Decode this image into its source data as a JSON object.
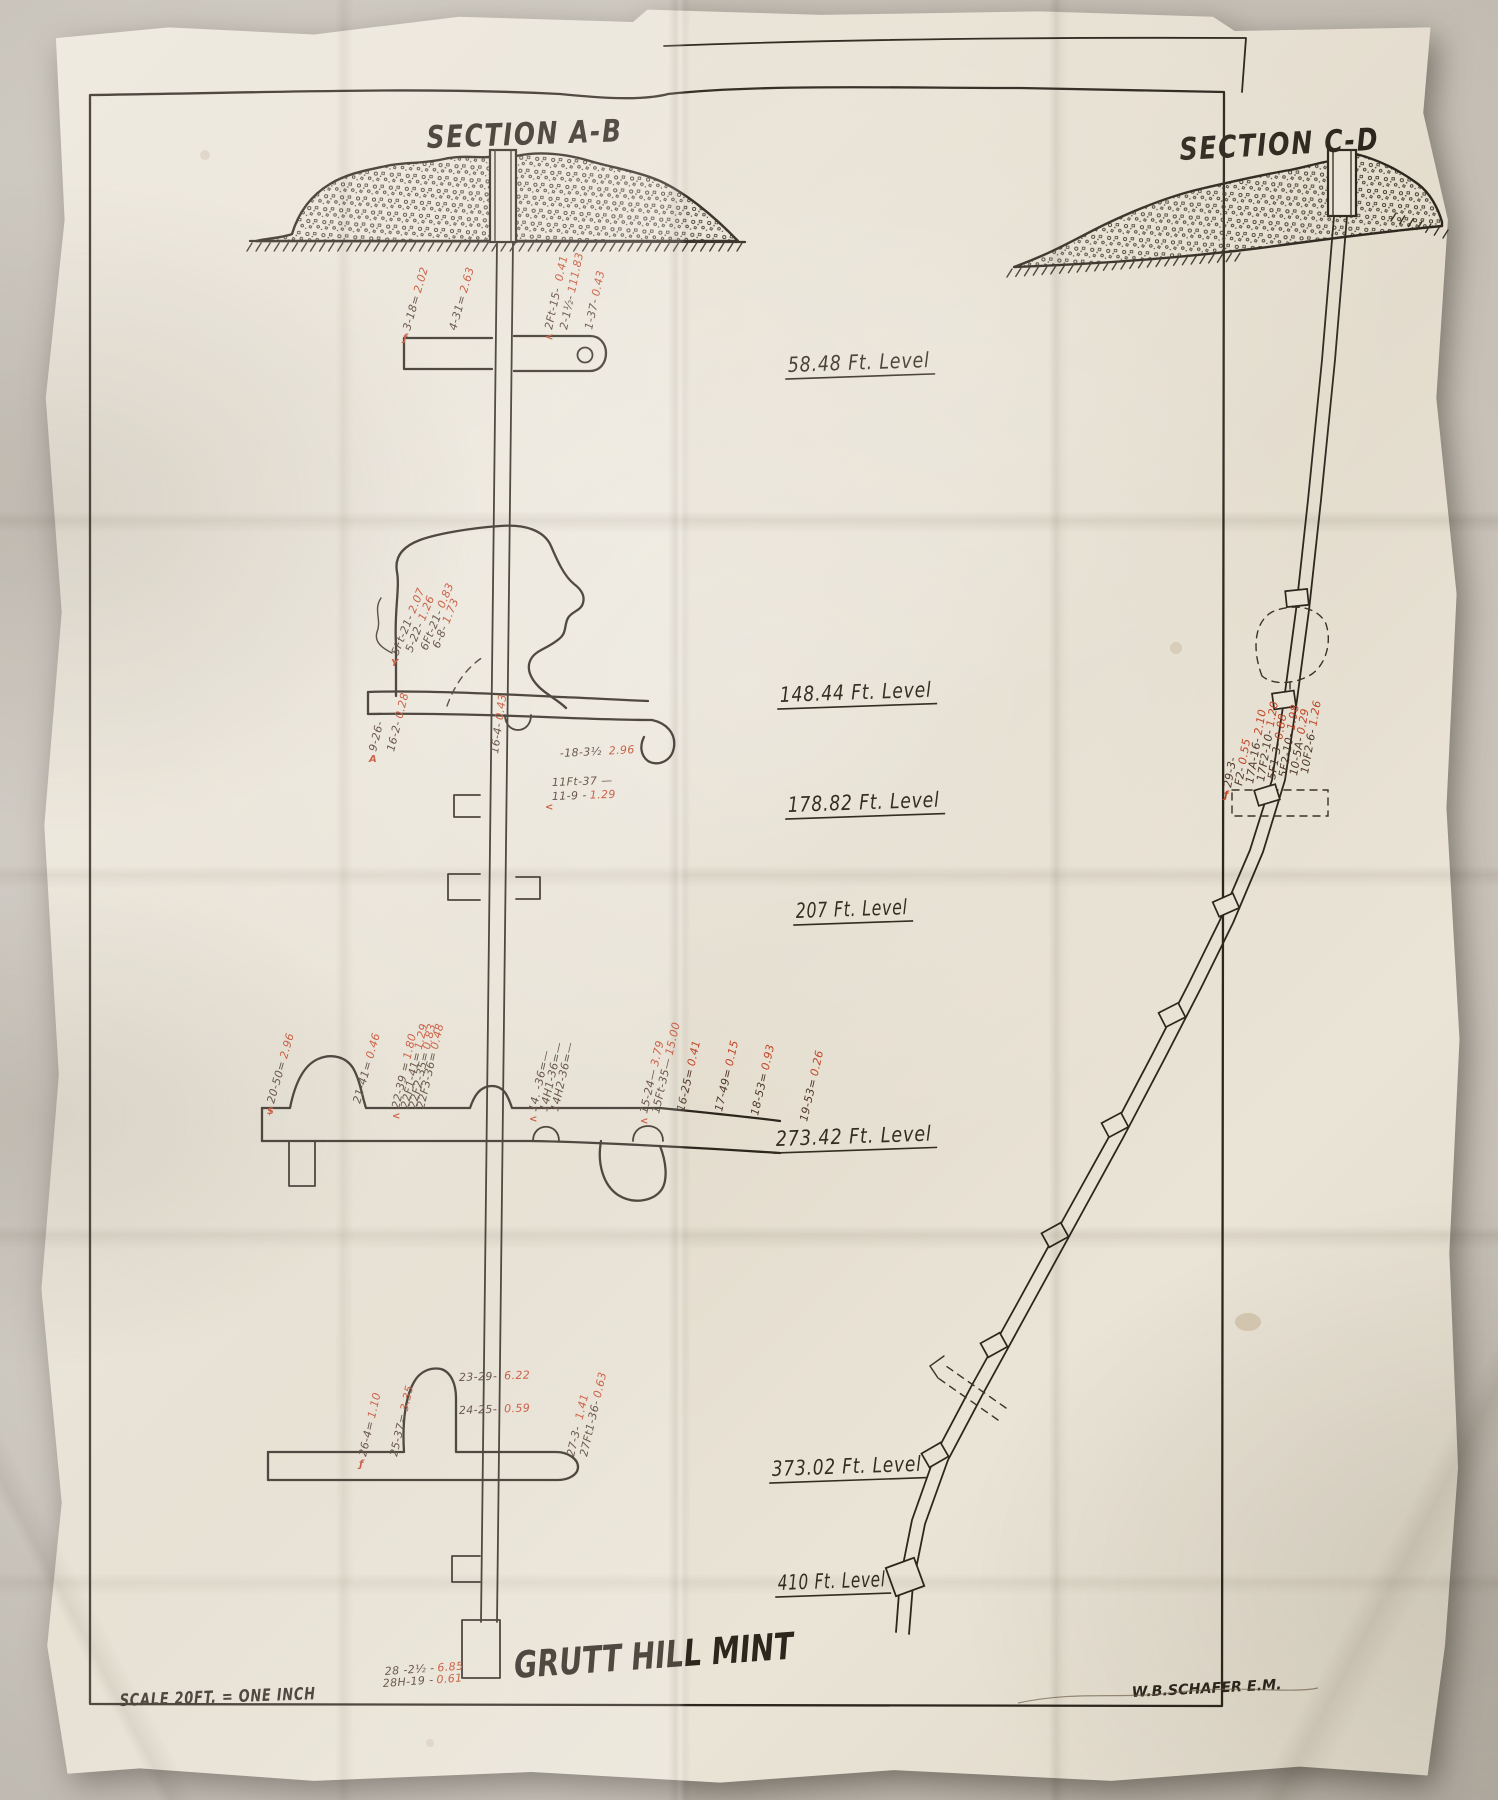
{
  "colors": {
    "ink": "#2d261d",
    "red_assay": "#c24526",
    "paper": "#e9e3d6"
  },
  "titles": {
    "section_ab": "SECTION A-B",
    "section_cd": "SECTION C-D"
  },
  "footer": {
    "mine_name": "GRUTT HILL MINT",
    "scale_note": "SCALE 20FT. = ONE INCH",
    "engineer": "W.B.SCHAFER E.M."
  },
  "levels": [
    {
      "label": "58.48 Ft. Level",
      "x": 788,
      "y": 372,
      "w": 142
    },
    {
      "label": "148.44 Ft. Level",
      "x": 780,
      "y": 702,
      "w": 152
    },
    {
      "label": "178.82 Ft. Level",
      "x": 788,
      "y": 812,
      "w": 152
    },
    {
      "label": "207 Ft. Level",
      "x": 796,
      "y": 918,
      "w": 112
    },
    {
      "label": "273.42 Ft. Level",
      "x": 776,
      "y": 1146,
      "w": 156
    },
    {
      "label": "373.02 Ft. Level",
      "x": 772,
      "y": 1476,
      "w": 150
    },
    {
      "label": "410 Ft. Level",
      "x": 778,
      "y": 1590,
      "w": 108
    }
  ],
  "annotations": [
    {
      "x": 410,
      "y": 331,
      "rot": -74,
      "black": "3-18=",
      "red": "2.02",
      "mark": "ƒ"
    },
    {
      "x": 456,
      "y": 331,
      "rot": -74,
      "black": "4-31=",
      "red": "2.63"
    },
    {
      "x": 552,
      "y": 330,
      "rot": -78,
      "black": "2Ft-15- ",
      "red": "0.41",
      "mark": "<"
    },
    {
      "x": 567,
      "y": 330,
      "rot": -78,
      "black": "2-1½-",
      "red": "111.83"
    },
    {
      "x": 592,
      "y": 330,
      "rot": -78,
      "black": "1-37-",
      "red": "0.43"
    },
    {
      "x": 398,
      "y": 656,
      "rot": -68,
      "black": "5Ft-21-",
      "red": "2.07",
      "mark": "Y"
    },
    {
      "x": 412,
      "y": 653,
      "rot": -68,
      "black": "5-22-",
      "red": "1.26"
    },
    {
      "x": 427,
      "y": 651,
      "rot": -68,
      "black": "6Ft-21-",
      "red": "0.83"
    },
    {
      "x": 439,
      "y": 649,
      "rot": -68,
      "black": "6-8-",
      "red": "1.73"
    },
    {
      "x": 376,
      "y": 752,
      "rot": -76,
      "black": "9-26-",
      "red": "",
      "mark": "A"
    },
    {
      "x": 394,
      "y": 752,
      "rot": -76,
      "black": "16-2-",
      "red": "0.28"
    },
    {
      "x": 498,
      "y": 754,
      "rot": -82,
      "black": "16-4-",
      "red": "0.43"
    },
    {
      "x": 560,
      "y": 757,
      "rot": -3,
      "black": "-18-3½ ",
      "red": "2.96"
    },
    {
      "x": 552,
      "y": 786,
      "rot": -2,
      "black": "11Ft-37 —",
      "red": ""
    },
    {
      "x": 552,
      "y": 800,
      "rot": -2,
      "black": "11-9 -",
      "red": "1.29",
      "mark": "<"
    },
    {
      "x": 274,
      "y": 1104,
      "rot": -74,
      "black": "20-50=",
      "red": "2.96",
      "mark": "$"
    },
    {
      "x": 360,
      "y": 1104,
      "rot": -74,
      "black": "21-41=",
      "red": "0.46"
    },
    {
      "x": 399,
      "y": 1109,
      "rot": -77,
      "black": "22-39 =",
      "red": "1.80",
      "mark": "<"
    },
    {
      "x": 408,
      "y": 1109,
      "rot": -77,
      "black": "22F1-41=",
      "red": "1.29"
    },
    {
      "x": 416,
      "y": 1109,
      "rot": -77,
      "black": "22F2-35=",
      "red": "0.83"
    },
    {
      "x": 424,
      "y": 1109,
      "rot": -77,
      "black": "22F3-36=",
      "red": "0.48"
    },
    {
      "x": 536,
      "y": 1112,
      "rot": -77,
      "black": "14. -36=—",
      "red": "",
      "mark": "<"
    },
    {
      "x": 547,
      "y": 1112,
      "rot": -77,
      "black": "14H1-36=—",
      "red": ""
    },
    {
      "x": 558,
      "y": 1112,
      "rot": -77,
      "black": "14H2-36=—",
      "red": ""
    },
    {
      "x": 647,
      "y": 1114,
      "rot": -77,
      "black": "15-24—",
      "red": "3.79",
      "mark": "<"
    },
    {
      "x": 659,
      "y": 1114,
      "rot": -77,
      "black": "15Ft-35—",
      "red": "15.00"
    },
    {
      "x": 684,
      "y": 1112,
      "rot": -77,
      "black": "16-25=",
      "red": "0.41"
    },
    {
      "x": 722,
      "y": 1112,
      "rot": -77,
      "black": "17-49=",
      "red": "0.15"
    },
    {
      "x": 758,
      "y": 1116,
      "rot": -77,
      "black": "18-53=",
      "red": "0.93"
    },
    {
      "x": 807,
      "y": 1122,
      "rot": -77,
      "black": "19-53=",
      "red": "0.26"
    },
    {
      "x": 366,
      "y": 1457,
      "rot": -77,
      "black": "26-4=",
      "red": "1.10",
      "mark": "ƒ"
    },
    {
      "x": 397,
      "y": 1457,
      "rot": -77,
      "black": "25-37=",
      "red": "3.35"
    },
    {
      "x": 459,
      "y": 1381,
      "rot": -2,
      "black": "23-29- ",
      "red": "6.22"
    },
    {
      "x": 459,
      "y": 1414,
      "rot": -2,
      "black": "24-25- ",
      "red": "0.59"
    },
    {
      "x": 574,
      "y": 1457,
      "rot": -77,
      "black": "27-3- ",
      "red": "1.41"
    },
    {
      "x": 587,
      "y": 1457,
      "rot": -77,
      "black": "27Ft1-36-",
      "red": "0.63"
    },
    {
      "x": 385,
      "y": 1675,
      "rot": -4,
      "black": "28 -2½ -",
      "red": "6.85"
    },
    {
      "x": 383,
      "y": 1687,
      "rot": -4,
      "black": "28H-19 -",
      "red": "0.61"
    },
    {
      "x": 1231,
      "y": 788,
      "rot": -80,
      "black": "29-3-",
      "red": "",
      "mark": "ƒ"
    },
    {
      "x": 1242,
      "y": 786,
      "rot": -80,
      "black": "F2-",
      "red": "0.55"
    },
    {
      "x": 1253,
      "y": 784,
      "rot": -80,
      "black": "17A-16-",
      "red": "2.10"
    },
    {
      "x": 1264,
      "y": 782,
      "rot": -80,
      "black": "17F2-10-",
      "red": "1.20"
    },
    {
      "x": 1275,
      "y": 780,
      "rot": -80,
      "black": "5F1-3-",
      "red": "0.88"
    },
    {
      "x": 1286,
      "y": 778,
      "rot": -80,
      "black": "5F2-10-",
      "red": "1.98"
    },
    {
      "x": 1297,
      "y": 776,
      "rot": -80,
      "black": "10-5A-",
      "red": "0.29"
    },
    {
      "x": 1308,
      "y": 774,
      "rot": -80,
      "black": "10F2-6-",
      "red": "1.26"
    }
  ]
}
